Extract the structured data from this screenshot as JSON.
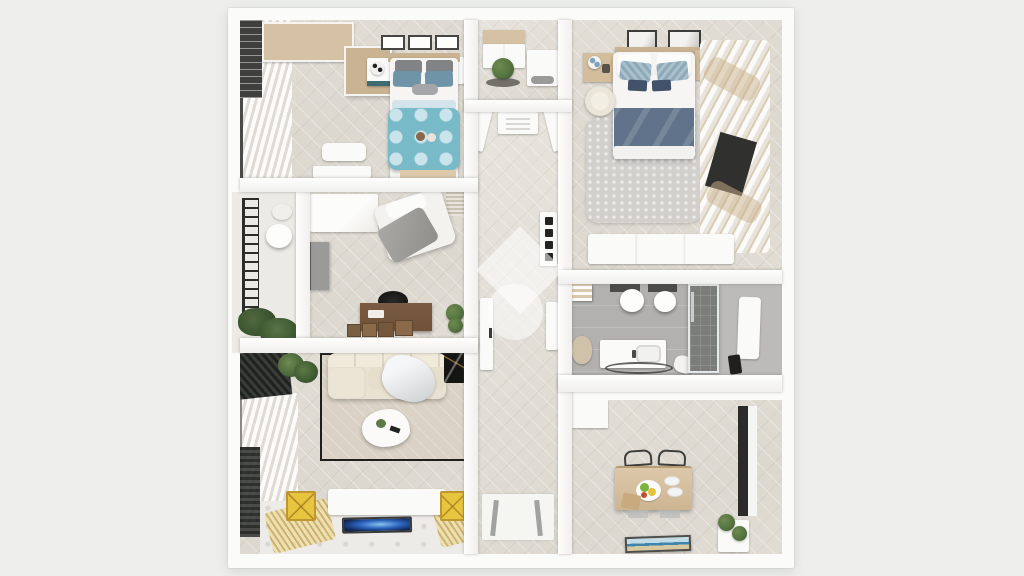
{
  "meta": {
    "type": "3d-floorplan-render",
    "view": "top-down",
    "description": "Photorealistic top-down 3D render of a two-bedroom apartment floor plan centered on a light gray background, with a white diamond-and-circle watermark logo over the central hallway. No text is rendered in the image."
  },
  "colors": {
    "bg": "#eeefec",
    "wall": "#fbfbf9",
    "white": "#fafaf8",
    "floor-wood": "#e2ded6",
    "floor-wood-light": "#e7e4dd",
    "floor-bath": "#b2b1af",
    "floor-bath-dark": "#7c7c7a",
    "balcony-floor": "#eceae5",
    "teal": "#79bac9",
    "teal-pale": "#c9e4ea",
    "steel-blue": "#6f94a8",
    "pillow-gray": "#818386",
    "navy-blanket": "#60738a",
    "navy-pillow": "#42526a",
    "tan-wood": "#d5c2a4",
    "tan-wood-deep": "#c9b392",
    "desk-brown": "#6f5138",
    "rug-beige": "#dad3c5",
    "rug-gray": "#d2d0cc",
    "sofa-cream": "#e9e2d2",
    "gold": "#e7c53f",
    "gold-deep": "#bf9730",
    "tv-blue": "#2f66c0",
    "green": "#55743f",
    "green-dark": "#3f5c33",
    "black": "#1e1e1c"
  },
  "watermark": {
    "shapes": [
      "rotated-square",
      "circle"
    ],
    "color": "#ffffff",
    "opacity": "0.5",
    "position": "center-hallway"
  },
  "rooms": [
    {
      "id": "bedroom-small",
      "label": "Small bedroom",
      "position": "top-left",
      "furniture": [
        "corner wardrobe",
        "three wall picture frames",
        "single bed with teal polka-dot duvet",
        "gray and blue pillows",
        "two nightstands with spotted lamps",
        "vanity desk",
        "low dresser",
        "window with white blinds"
      ]
    },
    {
      "id": "utility-room",
      "label": "Utility room",
      "position": "top-center",
      "furniture": [
        "upper cabinet",
        "potted plant",
        "washing machine",
        "dark floor mat"
      ]
    },
    {
      "id": "bedroom-master",
      "label": "Master bedroom",
      "position": "top-right",
      "furniture": [
        "double bed with slate-blue blanket",
        "two wall picture frames",
        "headboard shelf",
        "two wooden nightstands with lamps",
        "cream armchair",
        "shaggy gray rug",
        "long white dresser",
        "billowing white curtains over window"
      ]
    },
    {
      "id": "home-office",
      "label": "Home office / guest room",
      "position": "middle-left",
      "furniture": [
        "white wardrobe",
        "wall-mounted TV",
        "daybed with gray throw",
        "dark wood desk",
        "black office chair",
        "storage crates",
        "potted plant"
      ]
    },
    {
      "id": "balcony",
      "label": "Balcony",
      "position": "left-edge",
      "furniture": [
        "black metal railing",
        "round bistro table",
        "chair",
        "planter greenery"
      ]
    },
    {
      "id": "hallway",
      "label": "Hallway",
      "position": "center",
      "furniture": [
        "ceiling vent",
        "intercom switch panel",
        "open interior doors",
        "entry mat with door marks"
      ]
    },
    {
      "id": "bathroom",
      "label": "Bathroom",
      "position": "middle-right",
      "furniture": [
        "wall-hung toilet",
        "bidet",
        "towel shelf",
        "towel pile",
        "vanity with sink",
        "dark cord bath mat",
        "glass shower with dark tile",
        "leaning mirror panel"
      ]
    },
    {
      "id": "living-room",
      "label": "Living room",
      "position": "bottom-left",
      "furniture": [
        "cream sectional sofa",
        "draped throw blanket",
        "black marble console",
        "organic white coffee table",
        "beige rug with black border",
        "white TV lowboard",
        "flat TV with galaxy screen",
        "two yellow side tables with gold legs",
        "tall plant",
        "dark radiator",
        "vertical window blinds",
        "gold reflective floor panels"
      ]
    },
    {
      "id": "kitchen-dining",
      "label": "Kitchen / dining room",
      "position": "bottom-right",
      "furniture": [
        "wooden dining table",
        "two dark wire chairs",
        "fruit platter",
        "white plates",
        "cutting board",
        "framed seascape picture",
        "white planter box",
        "tall dark-framed window"
      ]
    }
  ]
}
